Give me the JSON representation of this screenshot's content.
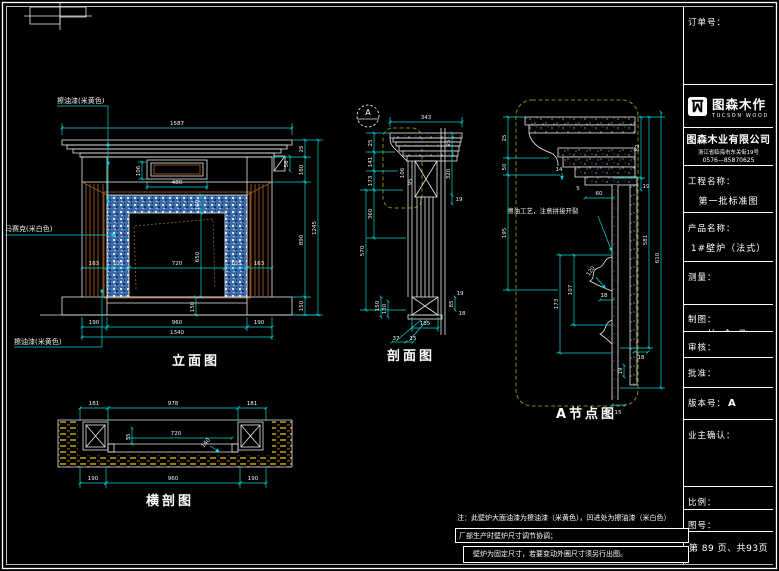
{
  "sheet": {
    "page_bg": "#000000",
    "line_white": "#ffffff",
    "dim_cyan": "#00d8d8",
    "wood_brown": "#9b5a20",
    "hatch_olive": "#8f8400",
    "mosaic_blue": "#3e6cab"
  },
  "views": {
    "elevation": {
      "title": "立面图",
      "labels": {
        "paint_top": "擦油漆(米黄色)",
        "mosaic": "马赛克(米白色)",
        "paint_bottom": "擦油漆(米黄色)"
      },
      "dims": {
        "total_width": "1587",
        "panel_width": "480",
        "panel_height": "106",
        "right_top": "25",
        "right_frieze": "180",
        "corbel": "56",
        "mosaic_band": "100",
        "opening_height": "650",
        "leg_left": "163",
        "band_left": "103",
        "opening_width": "720",
        "band_right": "103",
        "leg_right": "163",
        "hearth_height": "150",
        "right_body": "890",
        "right_base": "150",
        "right_total": "1245",
        "base_left": "190",
        "base_center": "960",
        "base_right": "190",
        "base_total": "1340"
      }
    },
    "section": {
      "title": "剖面图",
      "marker": "A",
      "dims": {
        "top_width": "343",
        "left_1": "25",
        "left_2": "141",
        "left_3": "173",
        "left_4": "360",
        "left_5": "570",
        "base_a": "150",
        "base_b": "130",
        "right_1": "25",
        "right_2": "320",
        "right_3": "19",
        "right_4": "85",
        "right_5": "18",
        "inner_1": "106",
        "inner_2": "95",
        "bottom_1": "185",
        "bottom_2": "37",
        "bottom_3": "15"
      }
    },
    "detail": {
      "title": "A节点图",
      "note": "擦油工艺，注意拼接开裂",
      "dims": {
        "d1": "25",
        "d2": "50",
        "d3": "195",
        "d4": "14",
        "d5": "5",
        "d6": "60",
        "d7": "82",
        "d8": "19",
        "d9": "173",
        "d10": "107",
        "d11": "120",
        "d12": "18",
        "d13": "581",
        "d14": "610",
        "d15": "19",
        "d16": "18",
        "d17": "15"
      }
    },
    "plan": {
      "title": "横剖图",
      "dims": {
        "top_left": "181",
        "top_center": "978",
        "top_right": "181",
        "inner_depth": "35",
        "inner_width": "720",
        "inner_leader": "140",
        "bottom_left": "190",
        "bottom_center": "960",
        "bottom_right": "190"
      }
    }
  },
  "notes": {
    "line1": "注：此壁炉大面油漆为擦油漆（米黄色），凹进处为擦油漆（米白色）",
    "line2": "厂部生产时壁炉尺寸调节协调；",
    "line3": "壁炉为固定尺寸，若要变动外圈尺寸须另行出图。"
  },
  "titleblock": {
    "order_label": "订单号：",
    "logo_name": "图森木作",
    "logo_sub": "TUCSON WOOD",
    "company": "图森木业有限公司",
    "address": "浙江省临海市东关街19号",
    "phone": "0576—85870625",
    "project_label": "工程名称：",
    "project_value": "第一批标准图",
    "product_label": "产品名称：",
    "product_value": "1#壁炉（法式）",
    "measure_label": "测量：",
    "draft_label": "制图：",
    "draft_value": "杜 金 飞",
    "check_label": "审核：",
    "approve_label": "批准：",
    "version_label": "版本号：",
    "version_value": "A",
    "owner_label": "业主确认：",
    "scale_label": "比例：",
    "figno_label": "图号：",
    "page_info": "第 89 页、共93页"
  }
}
